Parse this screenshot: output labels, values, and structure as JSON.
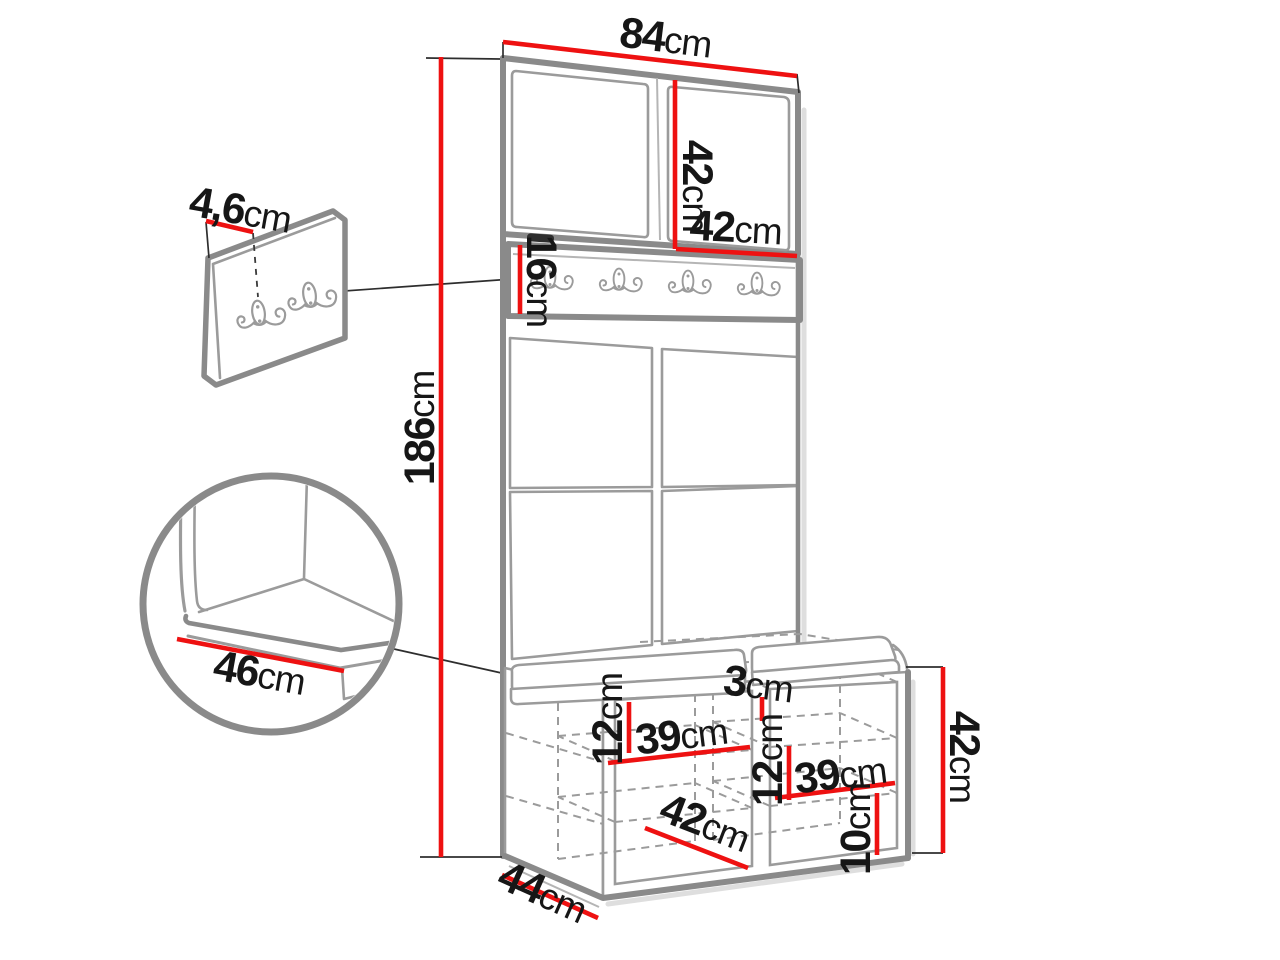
{
  "page": {
    "background": "#ffffff"
  },
  "colors": {
    "dimension_red": "#ee1111",
    "outline_gray": "#8a8a8a",
    "line_gray": "#9b9b9b",
    "leader_black": "#2e2e2e",
    "text_black": "#161616"
  },
  "diagram": {
    "type": "furniture dimension drawing",
    "unit": "cm",
    "rail_hook_count": 4,
    "wall_panel_hook_count": 2
  },
  "dimensions": {
    "total_height": {
      "value": "186",
      "unit": "cm"
    },
    "top_width": {
      "value": "84",
      "unit": "cm"
    },
    "door_height": {
      "value": "42",
      "unit": "cm"
    },
    "door_width": {
      "value": "42",
      "unit": "cm"
    },
    "hook_rail_height": {
      "value": "16",
      "unit": "cm"
    },
    "wall_panel_depth": {
      "value": "4,6",
      "unit": "cm"
    },
    "seat_depth": {
      "value": "46",
      "unit": "cm"
    },
    "left_shelf_spacing": {
      "value": "12",
      "unit": "cm"
    },
    "left_compartment_width": {
      "value": "39",
      "unit": "cm"
    },
    "center_divider_width": {
      "value": "3",
      "unit": "cm"
    },
    "right_shelf_spacing": {
      "value": "12",
      "unit": "cm"
    },
    "right_compartment_width": {
      "value": "39",
      "unit": "cm"
    },
    "bench_inner_width": {
      "value": "42",
      "unit": "cm"
    },
    "bottom_shelf_height": {
      "value": "10",
      "unit": "cm"
    },
    "bench_height": {
      "value": "42",
      "unit": "cm"
    },
    "bench_depth": {
      "value": "44",
      "unit": "cm"
    }
  }
}
